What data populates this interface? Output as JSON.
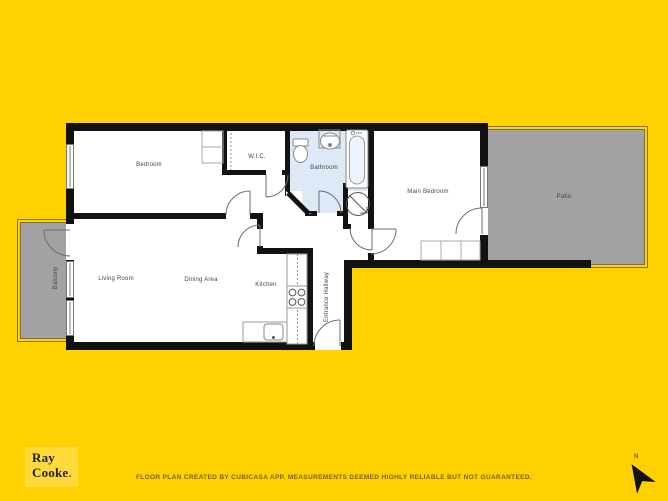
{
  "page": {
    "type": "estate-agent floor plan sheet",
    "background_color": "#ffd103"
  },
  "floor_plan": {
    "labels": {
      "bedroom": "Bedroom",
      "wic": "W.I.C.",
      "bathroom": "Bathroom",
      "main_bedroom": "Main Bedroom",
      "patio": "Patio",
      "living_room": "Living Room",
      "dining_area": "Dining Area",
      "kitchen": "Kitchen",
      "balcony": "Balcony",
      "entrance_hallway": "Entrance Hallway"
    },
    "colors": {
      "wall": "#121212",
      "room_floor": "#ffffff",
      "bathroom_floor": "#dde9f6",
      "outdoor_floor": "#a2a2a2",
      "outdoor_border": "#6f6f6f"
    }
  },
  "branding": {
    "logo_line1": "Ray",
    "logo_line2": "Cooke",
    "logo_dot": ".",
    "logo_text_color": "#23232e",
    "logo_dot_color": "#e0432d",
    "logo_panel_color": "#ffda3a"
  },
  "footer": {
    "disclaimer": "FLOOR PLAN CREATED BY CUBICASA APP. MEASUREMENTS DEEMED HIGHLY RELIABLE BUT NOT GUARANTEED."
  },
  "compass": {
    "label": "N"
  }
}
